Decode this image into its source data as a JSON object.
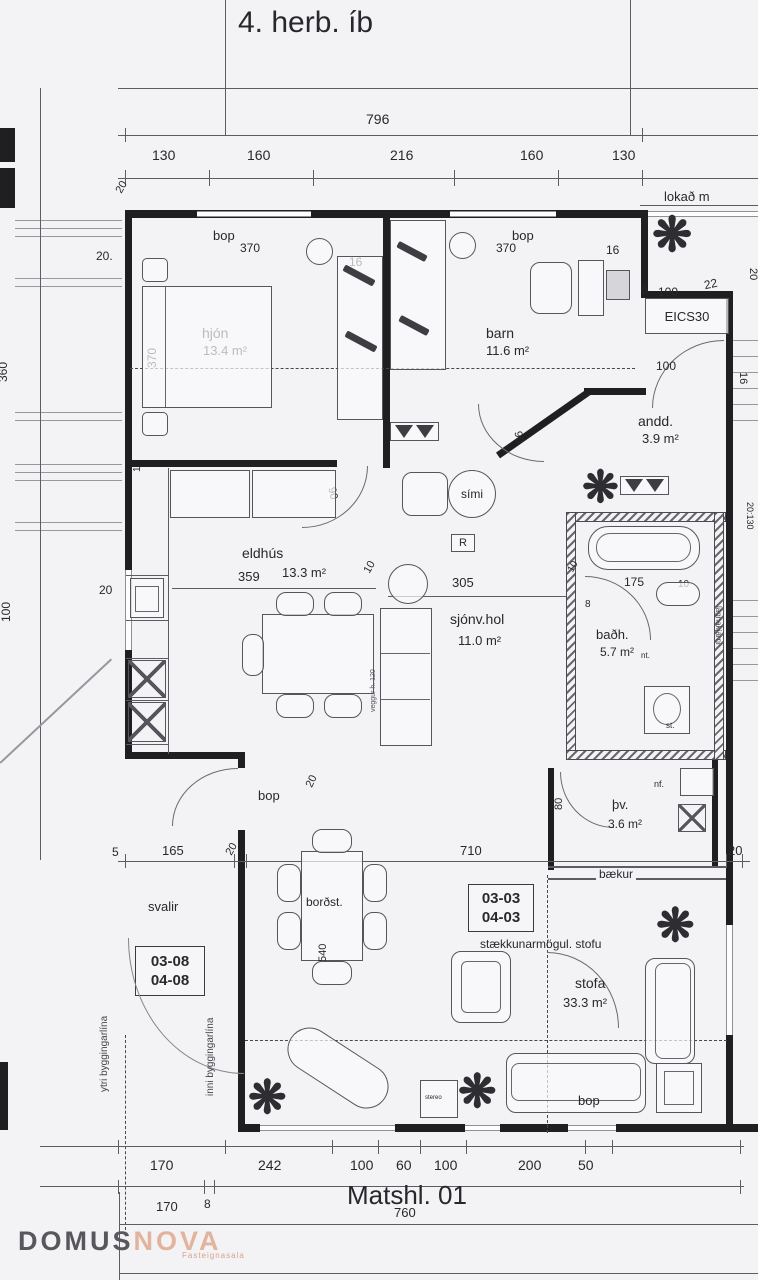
{
  "title": "4. herb. íb",
  "icons": {
    "plant": "❋"
  },
  "top": {
    "total": "796",
    "s1": "130",
    "s2": "160",
    "s3": "216",
    "s4": "160",
    "s5": "130",
    "corner": "20",
    "lokad": "lokað m"
  },
  "left": {
    "d20": "20.",
    "v370": "370",
    "v360": "360",
    "v100": "100",
    "v10": "10",
    "k20": "20",
    "s5": "5"
  },
  "hjon": {
    "bop": "bop",
    "b370": "370",
    "name": "hjón",
    "area": "13.4 m²",
    "c16": "16"
  },
  "barn": {
    "bop": "bop",
    "b370": "370",
    "name": "barn",
    "area": "11.6 m²",
    "c16": "16"
  },
  "andd": {
    "name": "andd.",
    "area": "3.9 m²",
    "d6": "6",
    "d100": "100",
    "d22": "22",
    "cab": "EICS30",
    "door": "100",
    "v20": "20",
    "v16": "16"
  },
  "eldhus": {
    "name": "eldhús",
    "area": "13.3 m²",
    "d359": "359",
    "d10": "10"
  },
  "hol": {
    "name": "sjónv.hol",
    "area": "11.0 m²",
    "d305": "305",
    "simi": "sími",
    "r": "R",
    "d90a": "90",
    "d90b": "90",
    "note": "veggur h. 120"
  },
  "badh": {
    "name": "baðh.",
    "area": "5.7 m²",
    "d175": "175",
    "d10a": "10",
    "d10b": "10",
    "d8": "8",
    "nt": "nt.",
    "st": "st.",
    "lagna": "lagnakjarni",
    "v20130": "20:130"
  },
  "thv": {
    "name": "þv.",
    "area": "3.6 m²",
    "nf": "nf.",
    "v80": "80"
  },
  "stofa": {
    "name": "stofa",
    "area": "33.3 m²",
    "ext": "stækkunarmögul. stofu",
    "baekur": "bækur",
    "d710": "710",
    "tagA": "03-03",
    "tagB": "04-03",
    "bop": "bop",
    "stereo": "stereo"
  },
  "bordst": {
    "name": "borðst.",
    "v540": "540",
    "bop": "bop",
    "d20": "20"
  },
  "svalir": {
    "name": "svalir",
    "d165": "165",
    "d20": "20",
    "tagA": "03-08",
    "tagB": "04-08",
    "ytri": "ytri byggingarlína",
    "inni": "inni byggingarlína"
  },
  "bottom": {
    "s1": "170",
    "s2": "242",
    "s3": "100",
    "s4": "60",
    "s5": "100",
    "s6": "200",
    "s7": "50",
    "r1": "170",
    "r2": "8",
    "r3": "760",
    "matshl": "Matshl. 01"
  },
  "logo": {
    "domus": "DOMUS",
    "nova": "NOVA",
    "sub": "Fasteignasala"
  }
}
